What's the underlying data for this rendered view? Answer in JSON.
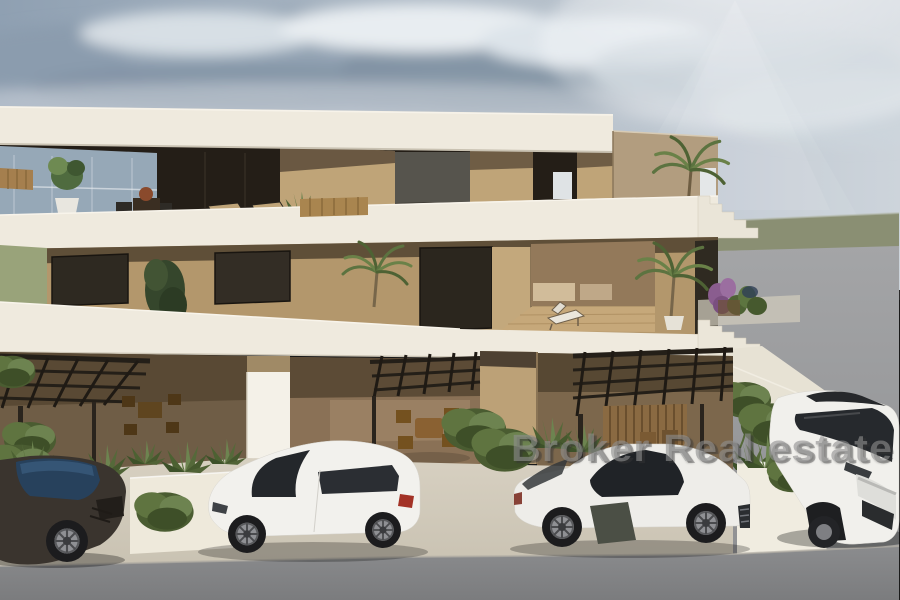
{
  "watermark": {
    "text": "Broker Real estate"
  },
  "scene": {
    "type": "architectural-3d-render",
    "description": "Modern three-level apartment building with white slab terraces, tan walls, pergola carports, landscaped planters and four parked cars under a partly cloudy sky with sun glare",
    "sky": {
      "condition": "partly-cloudy-with-sun-glare"
    },
    "vehicles": [
      {
        "label": "dark sports car"
      },
      {
        "label": "white hatchback"
      },
      {
        "label": "white sports coupe"
      },
      {
        "label": "white suv"
      }
    ]
  },
  "palette": {
    "sky_left": "#8fa0b2",
    "sky_right": "#cdd4db",
    "cloud_dark": "#8495a6",
    "sun_glow": "#ffffff",
    "horizon_green": "#8a8f73",
    "street_gray": "#a4a5a7",
    "road_gray": "#8b8c8e",
    "slab_white": "#efeade",
    "wall_tan": "#b3976c",
    "glazing_dark": "#241e17",
    "pergola_brown": "#2b251e",
    "plant_green": "#55693a",
    "driveway_beige": "#d7d0c1",
    "watermark_gray": "#8f8f8f"
  }
}
